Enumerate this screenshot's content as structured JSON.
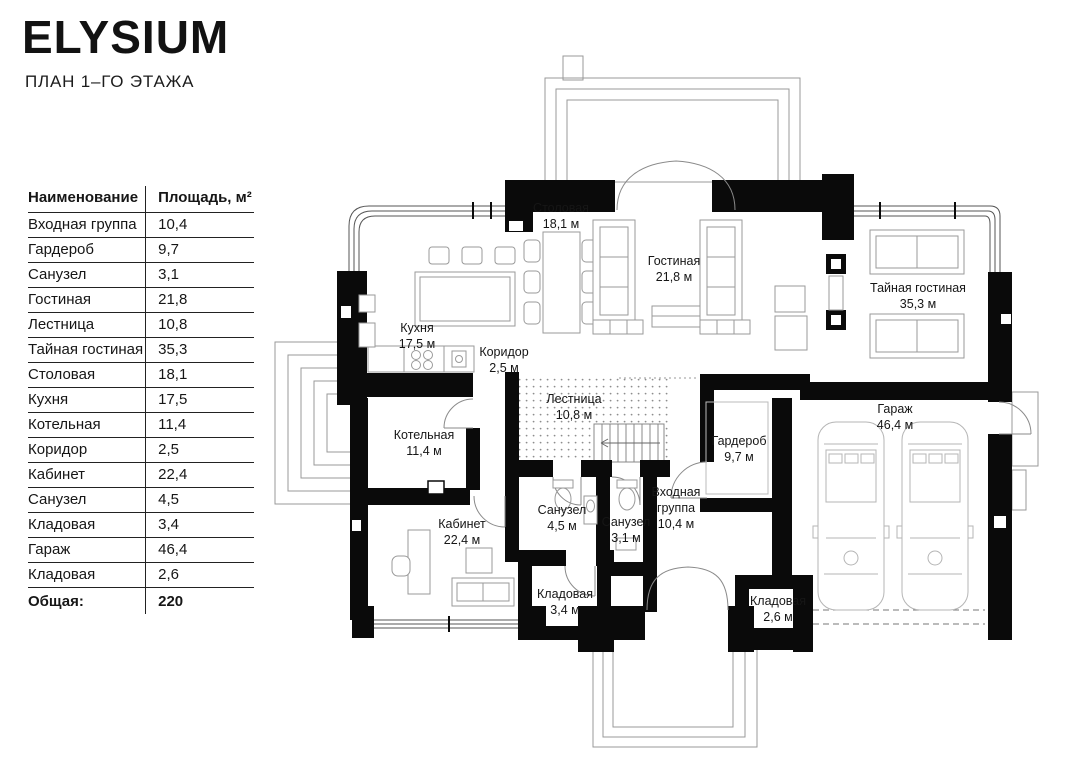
{
  "header": {
    "title": "ELYSIUM",
    "subtitle": "ПЛАН 1–ГО ЭТАЖА"
  },
  "table": {
    "col_name": "Наименование",
    "col_area": "Площадь, м²",
    "rows": [
      {
        "name": "Входная группа",
        "area": "10,4"
      },
      {
        "name": "Гардероб",
        "area": "9,7"
      },
      {
        "name": "Санузел",
        "area": "3,1"
      },
      {
        "name": "Гостиная",
        "area": "21,8"
      },
      {
        "name": "Лестница",
        "area": "10,8"
      },
      {
        "name": "Тайная гостиная",
        "area": "35,3"
      },
      {
        "name": "Столовая",
        "area": "18,1"
      },
      {
        "name": "Кухня",
        "area": "17,5"
      },
      {
        "name": "Котельная",
        "area": "11,4"
      },
      {
        "name": "Коридор",
        "area": "2,5"
      },
      {
        "name": "Кабинет",
        "area": "22,4"
      },
      {
        "name": "Санузел",
        "area": "4,5"
      },
      {
        "name": "Кладовая",
        "area": "3,4"
      },
      {
        "name": "Гараж",
        "area": "46,4"
      },
      {
        "name": "Кладовая",
        "area": "2,6"
      }
    ],
    "total_label": "Общая:",
    "total_value": "220"
  },
  "plan": {
    "rooms": [
      {
        "name": "Столовая",
        "area": "18,1 м"
      },
      {
        "name": "Гостиная",
        "area": "21,8 м"
      },
      {
        "name": "Тайная гостиная",
        "area": "35,3 м"
      },
      {
        "name": "Кухня",
        "area": "17,5 м"
      },
      {
        "name": "Коридор",
        "area": "2,5 м"
      },
      {
        "name": "Лестница",
        "area": "10,8 м"
      },
      {
        "name": "Котельная",
        "area": "11,4 м"
      },
      {
        "name": "Гардероб",
        "area": "9,7 м"
      },
      {
        "name": "Гараж",
        "area": "46,4 м"
      },
      {
        "name": "Кабинет",
        "area": "22,4 м"
      },
      {
        "name": "Санузел",
        "area": "4,5 м"
      },
      {
        "name": "Санузел",
        "area": "3,1 м"
      },
      {
        "name": "Входная группа",
        "area": "10,4 м"
      },
      {
        "name": "Кладовая",
        "area": "3,4 м"
      },
      {
        "name": "Кладовая",
        "area": "2,6 м"
      }
    ]
  }
}
